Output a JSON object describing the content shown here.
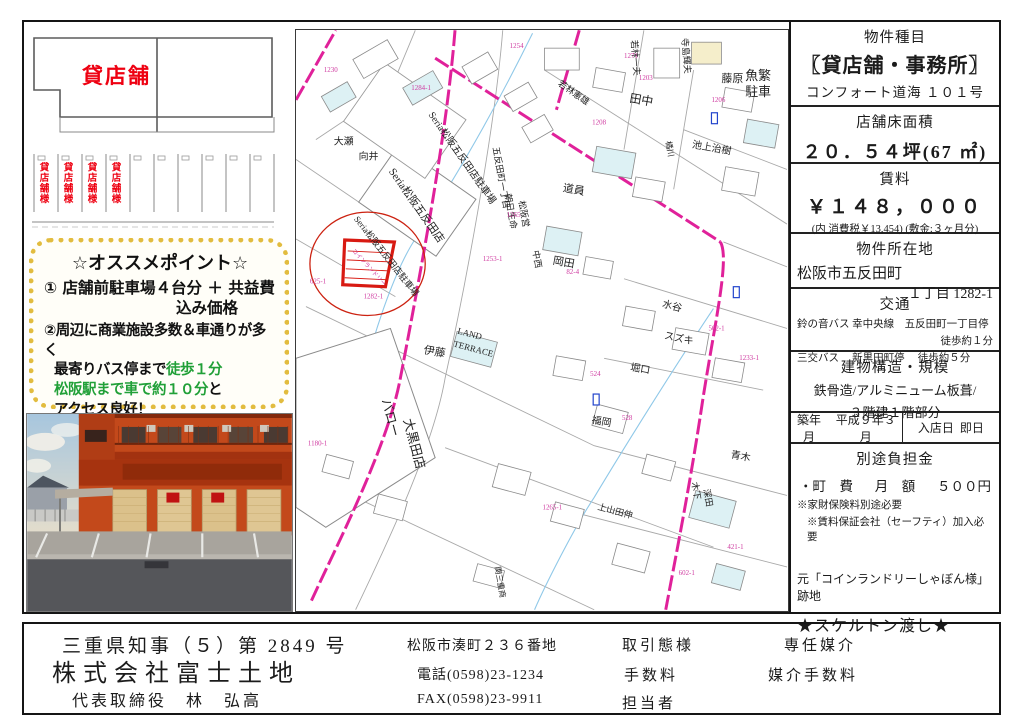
{
  "floor_plan": {
    "shop_label": "貸店舗",
    "stalls": [
      "貸店舗様",
      "貸店舗様",
      "貸店舗様",
      "貸店舗様"
    ]
  },
  "points": {
    "title": "☆オススメポイント☆",
    "line1a": "① 店舗前駐車場４台分 ＋ 共益費",
    "line1b": "込み価格",
    "line2a": "②周辺に商業施設多数＆車通りが多く",
    "line2b_black": "最寄りバス停まで",
    "line2b_green": "徒歩１分",
    "line2c_green": "松阪駅まで車で約１０分",
    "line2c_black": "と",
    "line2d": "アクセス良好！",
    "green_color": "#21a038",
    "border_color": "#e2bc3f"
  },
  "map": {
    "road_color": "#e0219a",
    "marker_color": "#d81a12",
    "property_note": "コインランドリー",
    "labels": [
      {
        "t": "Seria松阪五反田店駐車場",
        "x": 133,
        "y": 85,
        "r": 55,
        "s": 10
      },
      {
        "t": "Seria松阪五反田店",
        "x": 93,
        "y": 142,
        "r": 55,
        "s": 11
      },
      {
        "t": "Seria松阪五反田店駐車場",
        "x": 58,
        "y": 190,
        "r": 52,
        "s": 9
      },
      {
        "t": "五反田町一丁目",
        "x": 198,
        "y": 118,
        "r": 80,
        "s": 9
      },
      {
        "t": "朝日生命",
        "x": 210,
        "y": 165,
        "r": 80,
        "s": 9
      },
      {
        "t": "松阪営",
        "x": 224,
        "y": 172,
        "r": 80,
        "s": 9
      },
      {
        "t": "大瀬",
        "x": 38,
        "y": 115,
        "r": 0,
        "s": 10
      },
      {
        "t": "向井",
        "x": 63,
        "y": 130,
        "r": 0,
        "s": 10
      },
      {
        "t": "田中",
        "x": 335,
        "y": 72,
        "r": 10,
        "s": 12
      },
      {
        "t": "若林一夫",
        "x": 337,
        "y": 10,
        "r": 85,
        "s": 9
      },
      {
        "t": "寺島輝夫",
        "x": 388,
        "y": 8,
        "r": 85,
        "s": 9
      },
      {
        "t": "若林憲雄",
        "x": 263,
        "y": 55,
        "r": 35,
        "s": 9
      },
      {
        "t": "藤原",
        "x": 428,
        "y": 52,
        "r": 0,
        "s": 11
      },
      {
        "t": "池上治樹",
        "x": 398,
        "y": 118,
        "r": 10,
        "s": 10
      },
      {
        "t": "橘川",
        "x": 372,
        "y": 112,
        "r": 80,
        "s": 8
      },
      {
        "t": "道員",
        "x": 268,
        "y": 162,
        "r": 10,
        "s": 11
      },
      {
        "t": "岡田",
        "x": 258,
        "y": 235,
        "r": 10,
        "s": 11
      },
      {
        "t": "中西",
        "x": 238,
        "y": 222,
        "r": 80,
        "s": 9
      },
      {
        "t": "水谷",
        "x": 368,
        "y": 278,
        "r": 15,
        "s": 10
      },
      {
        "t": "スズキ",
        "x": 370,
        "y": 310,
        "r": 12,
        "s": 10
      },
      {
        "t": "伊藤",
        "x": 128,
        "y": 325,
        "r": 10,
        "s": 11
      },
      {
        "t": "堀口",
        "x": 336,
        "y": 342,
        "r": 10,
        "s": 10
      },
      {
        "t": "福岡",
        "x": 297,
        "y": 395,
        "r": 10,
        "s": 10
      },
      {
        "t": "木下",
        "x": 398,
        "y": 455,
        "r": 80,
        "s": 9
      },
      {
        "t": "深田",
        "x": 410,
        "y": 462,
        "r": 80,
        "s": 9
      },
      {
        "t": "青木",
        "x": 437,
        "y": 430,
        "r": 10,
        "s": 10
      },
      {
        "t": "上山田伸",
        "x": 303,
        "y": 482,
        "r": 15,
        "s": 9
      },
      {
        "t": "LAND",
        "x": 162,
        "y": 305,
        "r": 15,
        "s": 9
      },
      {
        "t": "TERRACE",
        "x": 158,
        "y": 318,
        "r": 15,
        "s": 9
      },
      {
        "t": "関三重商",
        "x": 200,
        "y": 540,
        "r": 80,
        "s": 8
      },
      {
        "t": "バロー",
        "x": 86,
        "y": 372,
        "r": 75,
        "s": 13
      },
      {
        "t": "大黒田店",
        "x": 108,
        "y": 392,
        "r": 75,
        "s": 13
      },
      {
        "t": "魚繁",
        "x": 452,
        "y": 50,
        "r": 0,
        "s": 13
      },
      {
        "t": "駐車",
        "x": 452,
        "y": 66,
        "r": 0,
        "s": 13
      }
    ],
    "parcel_numbers": [
      {
        "t": "1282-1",
        "x": 68,
        "y": 270
      },
      {
        "t": "1265",
        "x": 212,
        "y": 188
      },
      {
        "t": "1253-1",
        "x": 188,
        "y": 232
      },
      {
        "t": "1203",
        "x": 345,
        "y": 50
      },
      {
        "t": "1206",
        "x": 418,
        "y": 72
      },
      {
        "t": "1208",
        "x": 298,
        "y": 95
      },
      {
        "t": "1271",
        "x": 330,
        "y": 28
      },
      {
        "t": "1284-1",
        "x": 116,
        "y": 60
      },
      {
        "t": "625-1",
        "x": 14,
        "y": 255
      },
      {
        "t": "82-4",
        "x": 272,
        "y": 245
      },
      {
        "t": "524",
        "x": 296,
        "y": 348
      },
      {
        "t": "528",
        "x": 328,
        "y": 392
      },
      {
        "t": "562-1",
        "x": 415,
        "y": 302
      },
      {
        "t": "1233-1",
        "x": 446,
        "y": 332
      },
      {
        "t": "1230",
        "x": 28,
        "y": 42
      },
      {
        "t": "1180-1",
        "x": 12,
        "y": 418
      },
      {
        "t": "421-1",
        "x": 434,
        "y": 522
      },
      {
        "t": "1265-1",
        "x": 248,
        "y": 482
      },
      {
        "t": "602-1",
        "x": 385,
        "y": 548
      },
      {
        "t": "1254",
        "x": 215,
        "y": 18
      }
    ]
  },
  "details": {
    "type_label": "物件種目",
    "type_value": "〖貸店舗・事務所〗",
    "type_sub": "コンフォート道海 １０１号",
    "floor_area_label": "店舗床面積",
    "floor_area_value": "２０．５４坪(67 ㎡)",
    "rent_label": "賃料",
    "rent_value": "￥１４８，０００",
    "rent_note": "(内 消費税￥13,454) (敷金:３ヶ月分)",
    "location_label": "物件所在地",
    "location_value1": "松阪市五反田町",
    "location_value2": "１丁目 1282-1",
    "transport_label": "交通",
    "transport_line1": "鈴の音バス 幸中央線　五反田町一丁目停",
    "transport_line2": "徒歩約１分",
    "transport_line3": "三交バス　 新黒田町停　 徒歩約５分",
    "structure_label": "建物構造・規模",
    "structure_value1": "鉄骨造/アルミニューム板葺/",
    "structure_value2": "３階建１階部分",
    "built_label": "築年月",
    "built_value": "平成９年３月",
    "movein_label": "入店日",
    "movein_value": "即日",
    "extra_label": "別途負担金",
    "extra_item": "・町　費",
    "extra_freq": "月　額",
    "extra_amount": "５００円",
    "note1": "※家財保険料別途必要",
    "note2": "※賃料保証会社（セーフティ）加入必要",
    "former": "元「コインランドリーしゃぼん様」跡地",
    "handover": "★スケルトン渡し★"
  },
  "footer": {
    "license": "三重県知事（５）第 2849 号",
    "company": "株式会社富士土地",
    "representative": "代表取締役　林　弘高",
    "address": "松阪市湊町２３６番地",
    "phone": "電話(0598)23-1234",
    "fax": "FAX(0598)23-9911",
    "deal_type_label": "取引態様",
    "deal_type_value": "専任媒介",
    "fee_label": "手数料",
    "fee_value": "媒介手数料",
    "staff_label": "担当者"
  }
}
